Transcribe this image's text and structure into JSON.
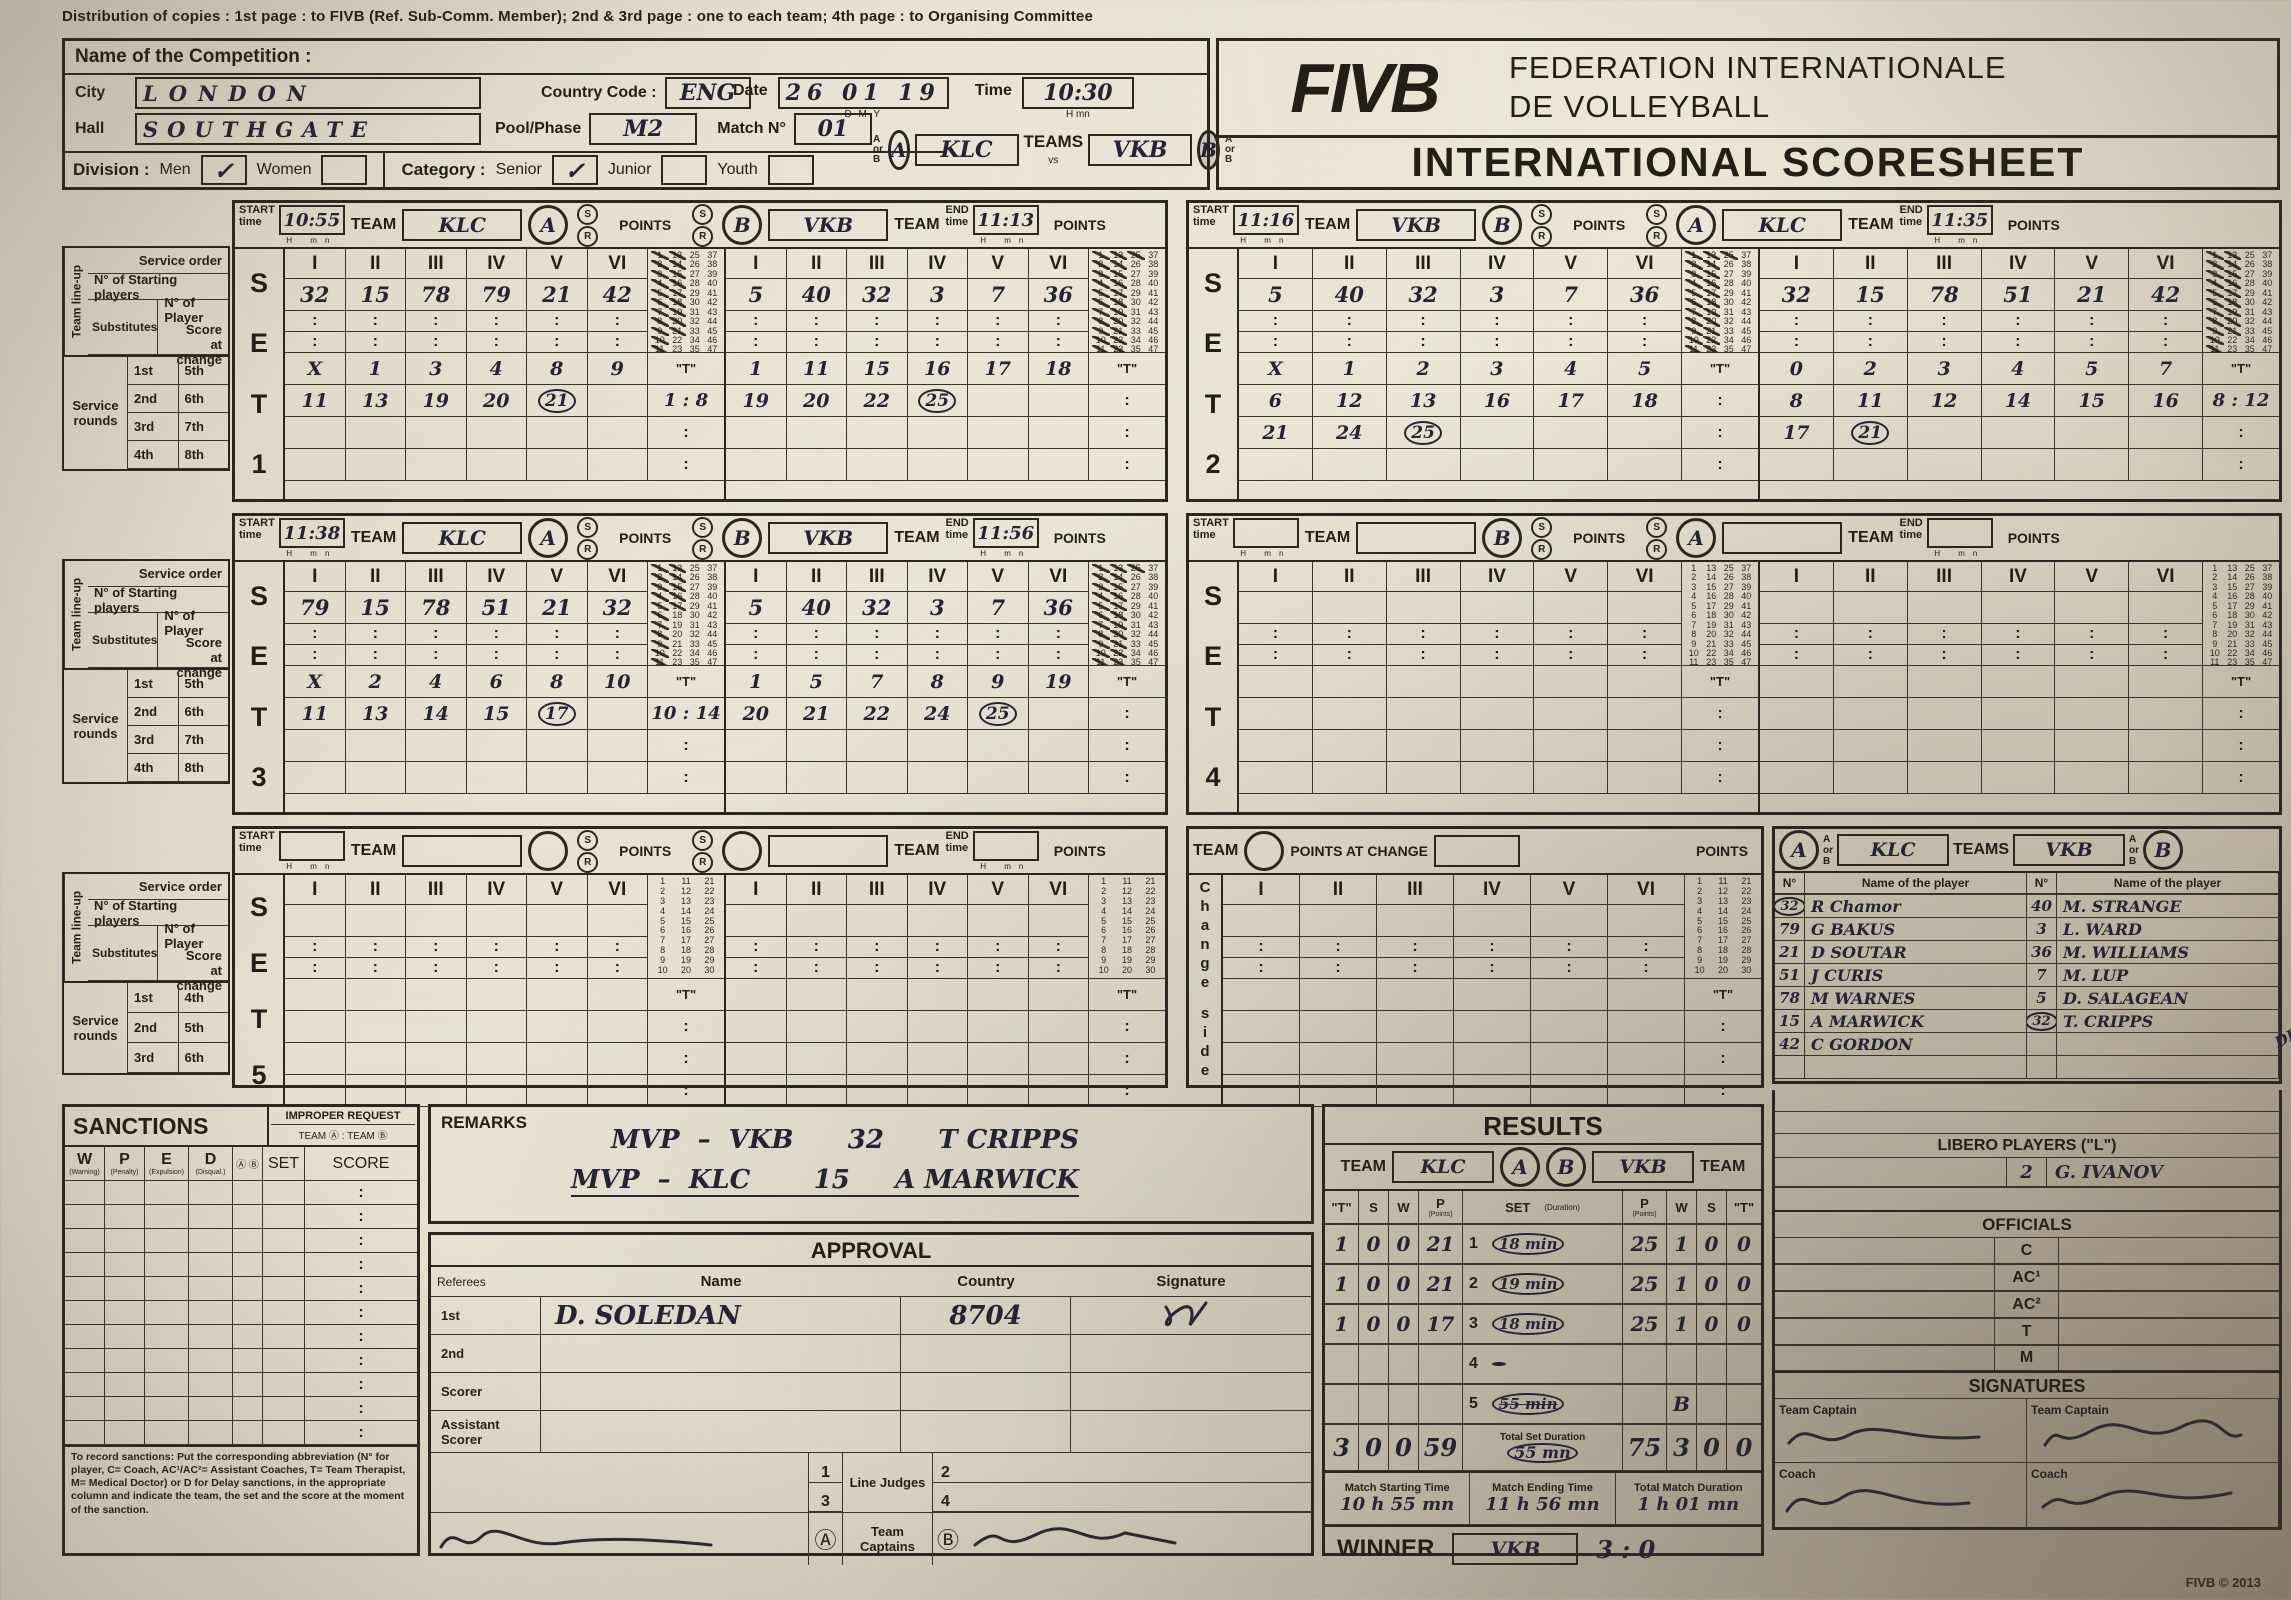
{
  "page": {
    "distribution": "Distribution of copies : 1st page : to FIVB (Ref. Sub-Comm. Member); 2nd & 3rd page : one to each team; 4th page : to Organising Committee",
    "fivb_logo": "FIVB",
    "federation_line1": "FEDERATION INTERNATIONALE",
    "federation_line2": "DE VOLLEYBALL",
    "scoresheet_title": "INTERNATIONAL SCORESHEET",
    "copyright": "FIVB © 2013"
  },
  "competition": {
    "name_label": "Name of the Competition :",
    "city_label": "City",
    "city_value": "LONDON",
    "hall_label": "Hall",
    "hall_value": "SOUTHGATE",
    "country_code_label": "Country Code :",
    "country_code_value": "ENG",
    "pool_label": "Pool/Phase",
    "pool_value": "M2",
    "match_label": "Match N°",
    "match_value": "01",
    "date_label": "Date",
    "date_value": "26 01 19",
    "date_sub": "D        M        Y",
    "time_label": "Time",
    "time_value": "10:30",
    "time_sub": "H      mn",
    "division_label": "Division :",
    "division_options": [
      "Men",
      "Women"
    ],
    "division_checked": "Men",
    "category_label": "Category :",
    "category_options": [
      "Senior",
      "Junior",
      "Youth"
    ],
    "category_checked": "Senior",
    "a_or_b": "A or B",
    "teams_label": "TEAMS",
    "vs_label": "vs",
    "team_a": "KLC",
    "team_b": "VKB",
    "check_mark": "✓"
  },
  "set_labels": {
    "set_word": [
      "S",
      "E",
      "T"
    ],
    "start": "START",
    "end": "END",
    "time": "time",
    "team": "TEAM",
    "points": "POINTS",
    "h": "H",
    "mn": "mn",
    "s": "S",
    "r": "R",
    "t_quote": "\"T\"",
    "colon": ":",
    "numerals": [
      "I",
      "II",
      "III",
      "IV",
      "V",
      "VI"
    ],
    "lineup": "Team line-up",
    "service_order": "Service order",
    "starting_players": "N° of Starting players",
    "substitutes": "Substitutes",
    "player_no": "N° of Player",
    "score_change": "Score at change",
    "service_rounds": "Service rounds",
    "rounds4": [
      [
        "1st",
        "5th"
      ],
      [
        "2nd",
        "6th"
      ],
      [
        "3rd",
        "7th"
      ],
      [
        "4th",
        "8th"
      ]
    ],
    "rounds3": [
      [
        "1st",
        "4th"
      ],
      [
        "2nd",
        "5th"
      ],
      [
        "3rd",
        "6th"
      ]
    ]
  },
  "sets": [
    {
      "num": "1",
      "start": "10:55",
      "end": "11:13",
      "left": {
        "letter": "A",
        "team": "KLC",
        "starters": [
          "32",
          "15",
          "78",
          "79",
          "21",
          "42"
        ],
        "rounds": [
          [
            "X",
            "1",
            "3",
            "4",
            "8",
            "9"
          ],
          [
            "11",
            "13",
            "19",
            "20",
            "(21)",
            ""
          ]
        ],
        "t": "1 : 8",
        "crossed": 21
      },
      "right": {
        "letter": "B",
        "team": "VKB",
        "starters": [
          "5",
          "40",
          "32",
          "3",
          "7",
          "36"
        ],
        "rounds": [
          [
            "1",
            "11",
            "15",
            "16",
            "17",
            "18"
          ],
          [
            "19",
            "20",
            "22",
            "(25)",
            "",
            ""
          ]
        ],
        "t": "",
        "crossed": 25
      }
    },
    {
      "num": "2",
      "start": "11:16",
      "end": "11:35",
      "left": {
        "letter": "B",
        "team": "VKB",
        "starters": [
          "5",
          "40",
          "32",
          "3",
          "7",
          "36"
        ],
        "rounds": [
          [
            "X",
            "1",
            "2",
            "3",
            "4",
            "5"
          ],
          [
            "6",
            "12",
            "13",
            "16",
            "17",
            "18"
          ],
          [
            "21",
            "24",
            "(25)",
            "",
            "",
            ""
          ]
        ],
        "t": "",
        "crossed": 25
      },
      "right": {
        "letter": "A",
        "team": "KLC",
        "starters": [
          "32",
          "15",
          "78",
          "51",
          "21",
          "42"
        ],
        "rounds": [
          [
            "0",
            "2",
            "3",
            "4",
            "5",
            "7"
          ],
          [
            "8",
            "11",
            "12",
            "14",
            "15",
            "16"
          ],
          [
            "17",
            "(21)",
            "",
            "",
            "",
            ""
          ]
        ],
        "t": "8 : 12",
        "crossed": 21
      }
    },
    {
      "num": "3",
      "start": "11:38",
      "end": "11:56",
      "left": {
        "letter": "A",
        "team": "KLC",
        "starters": [
          "79",
          "15",
          "78",
          "51",
          "21",
          "32"
        ],
        "rounds": [
          [
            "X",
            "2",
            "4",
            "6",
            "8",
            "10"
          ],
          [
            "11",
            "13",
            "14",
            "15",
            "(17)",
            ""
          ]
        ],
        "t": "10 : 14",
        "crossed": 17
      },
      "right": {
        "letter": "B",
        "team": "VKB",
        "starters": [
          "5",
          "40",
          "32",
          "3",
          "7",
          "36"
        ],
        "rounds": [
          [
            "1",
            "5",
            "7",
            "8",
            "9",
            "19"
          ],
          [
            "20",
            "21",
            "22",
            "24",
            "(25)",
            ""
          ]
        ],
        "t": "",
        "crossed": 25
      }
    },
    {
      "num": "4",
      "start": "",
      "end": "",
      "left": {
        "letter": "B",
        "team": "",
        "starters": [
          "",
          "",
          "",
          "",
          "",
          ""
        ],
        "rounds": [],
        "t": "",
        "crossed": 0
      },
      "right": {
        "letter": "A",
        "team": "",
        "starters": [
          "",
          "",
          "",
          "",
          "",
          ""
        ],
        "rounds": [],
        "t": "",
        "crossed": 0
      }
    },
    {
      "num": "5",
      "start": "",
      "end": "",
      "left": {
        "letter": "",
        "team": "",
        "starters": [
          "",
          "",
          "",
          "",
          "",
          ""
        ],
        "rounds": [],
        "t": "",
        "crossed": 0
      },
      "right": {
        "letter": "",
        "team": "",
        "starters": [
          "",
          "",
          "",
          "",
          "",
          ""
        ],
        "rounds": [],
        "t": "",
        "crossed": 0
      }
    }
  ],
  "change_side": {
    "vertical_top": "Change",
    "vertical_bottom": "side",
    "team_label": "TEAM",
    "points_at_change": "POINTS AT CHANGE",
    "points_label": "POINTS"
  },
  "roster": {
    "a_or_b": "A or B",
    "teams_label": "TEAMS",
    "team_a": "KLC",
    "team_b": "VKB",
    "letter_a": "A",
    "letter_b": "B",
    "no_label": "N°",
    "name_label": "Name of the player",
    "annotation": "DROP",
    "players_a": [
      {
        "no": "32",
        "name": "R Chamor",
        "circled": true
      },
      {
        "no": "79",
        "name": "G BAKUS",
        "circled": false
      },
      {
        "no": "21",
        "name": "D SOUTAR",
        "circled": false
      },
      {
        "no": "51",
        "name": "J CURIS",
        "circled": false
      },
      {
        "no": "78",
        "name": "M WARNES",
        "circled": false
      },
      {
        "no": "15",
        "name": "A MARWICK",
        "circled": false
      },
      {
        "no": "42",
        "name": "C GORDON",
        "circled": false
      }
    ],
    "players_b": [
      {
        "no": "40",
        "name": "M. STRANGE",
        "circled": false
      },
      {
        "no": "3",
        "name": "L. WARD",
        "circled": false
      },
      {
        "no": "36",
        "name": "M. WILLIAMS",
        "circled": false
      },
      {
        "no": "7",
        "name": "M. LUP",
        "circled": false
      },
      {
        "no": "5",
        "name": "D. SALAGEAN",
        "circled": false
      },
      {
        "no": "32",
        "name": "T. CRIPPS",
        "circled": true
      }
    ]
  },
  "sanctions": {
    "title": "SANCTIONS",
    "improper_title": "IMPROPER REQUEST",
    "improper_sub": "TEAM Ⓐ : TEAM Ⓑ",
    "cols": [
      {
        "k": "W",
        "sub": "(Warning)"
      },
      {
        "k": "P",
        "sub": "(Penalty)"
      },
      {
        "k": "E",
        "sub": "(Expulsion)"
      },
      {
        "k": "D",
        "sub": "(Disqual.)"
      }
    ],
    "ab_col": "Ⓐ Ⓑ",
    "set_col": "SET",
    "score_col": "SCORE",
    "footnote": "To record sanctions: Put the corresponding abbreviation (N° for player, C= Coach, AC¹/AC²= Assistant Coaches, T= Team Therapist, M= Medical Doctor) or D for Delay sanctions, in the appropriate column and indicate the team, the set and the score at the moment of the sanction."
  },
  "remarks": {
    "title": "REMARKS",
    "lines": [
      "MVP  –  VKB      32      T CRIPPS",
      "MVP  –  KLC       15     A MARWICK"
    ]
  },
  "approval": {
    "title": "APPROVAL",
    "referees_label": "Referees",
    "name_col": "Name",
    "country_col": "Country",
    "signature_col": "Signature",
    "rows": [
      {
        "label": "1st",
        "name": "D. SOLEDAN",
        "country": "8704",
        "signed": true
      },
      {
        "label": "2nd",
        "name": "",
        "country": "",
        "signed": false
      },
      {
        "label": "Scorer",
        "name": "",
        "country": "",
        "signed": false
      },
      {
        "label": "Assistant Scorer",
        "name": "",
        "country": "",
        "signed": false
      }
    ],
    "line_judges_label": "Line Judges",
    "line_judge_nums": [
      "1",
      "2",
      "3",
      "4"
    ],
    "captains_label": "Team Captains",
    "captain_a": "Ⓐ",
    "captain_b": "Ⓑ"
  },
  "results": {
    "title": "RESULTS",
    "team_label": "TEAM",
    "team_a": "KLC",
    "team_b": "VKB",
    "letter_a": "A",
    "letter_b": "B",
    "col_t": "\"T\"",
    "col_s": "S",
    "col_w": "W",
    "col_p": "P",
    "col_p_sub": "(Points)",
    "col_set": "SET",
    "col_dur": "(Duration)",
    "rows": [
      {
        "a": [
          "1",
          "0",
          "0",
          "21"
        ],
        "set": "1",
        "dur": "(18 min)",
        "dur_struck": false,
        "b": [
          "25",
          "1",
          "0",
          "0"
        ]
      },
      {
        "a": [
          "1",
          "0",
          "0",
          "21"
        ],
        "set": "2",
        "dur": "(19 min)",
        "dur_struck": false,
        "b": [
          "25",
          "1",
          "0",
          "0"
        ]
      },
      {
        "a": [
          "1",
          "0",
          "0",
          "17"
        ],
        "set": "3",
        "dur": "(18 min)",
        "dur_struck": false,
        "b": [
          "25",
          "1",
          "0",
          "0"
        ]
      },
      {
        "a": [
          "",
          "",
          "",
          ""
        ],
        "set": "4",
        "dur": "(        )",
        "dur_struck": false,
        "b": [
          "",
          "",
          "",
          ""
        ]
      },
      {
        "a": [
          "",
          "",
          "",
          ""
        ],
        "set": "5",
        "dur": "(55 min)",
        "dur_struck": true,
        "b": [
          "",
          "B",
          "",
          ""
        ]
      }
    ],
    "totals": {
      "a": [
        "3",
        "0",
        "0",
        "59"
      ],
      "label": "Total Set Duration",
      "dur": "(55  mn)",
      "b": [
        "75",
        "3",
        "0",
        "0"
      ]
    },
    "times": [
      {
        "label": "Match Starting Time",
        "value": "10 h 55 mn"
      },
      {
        "label": "Match Ending Time",
        "value": "11 h 56 mn"
      },
      {
        "label": "Total Match Duration",
        "value": "1 h 01 mn"
      }
    ],
    "winner_label": "WINNER",
    "winner": "VKB",
    "score": "3 : 0"
  },
  "libero": {
    "title": "LIBERO PLAYERS (\"L\")",
    "entry_no": "2",
    "entry_name": "G. IVANOV"
  },
  "officials": {
    "title": "OFFICIALS",
    "rows": [
      "C",
      "AC¹",
      "AC²",
      "T",
      "M"
    ]
  },
  "signatures": {
    "title": "SIGNATURES",
    "captain_label": "Team Captain",
    "coach_label": "Coach"
  }
}
